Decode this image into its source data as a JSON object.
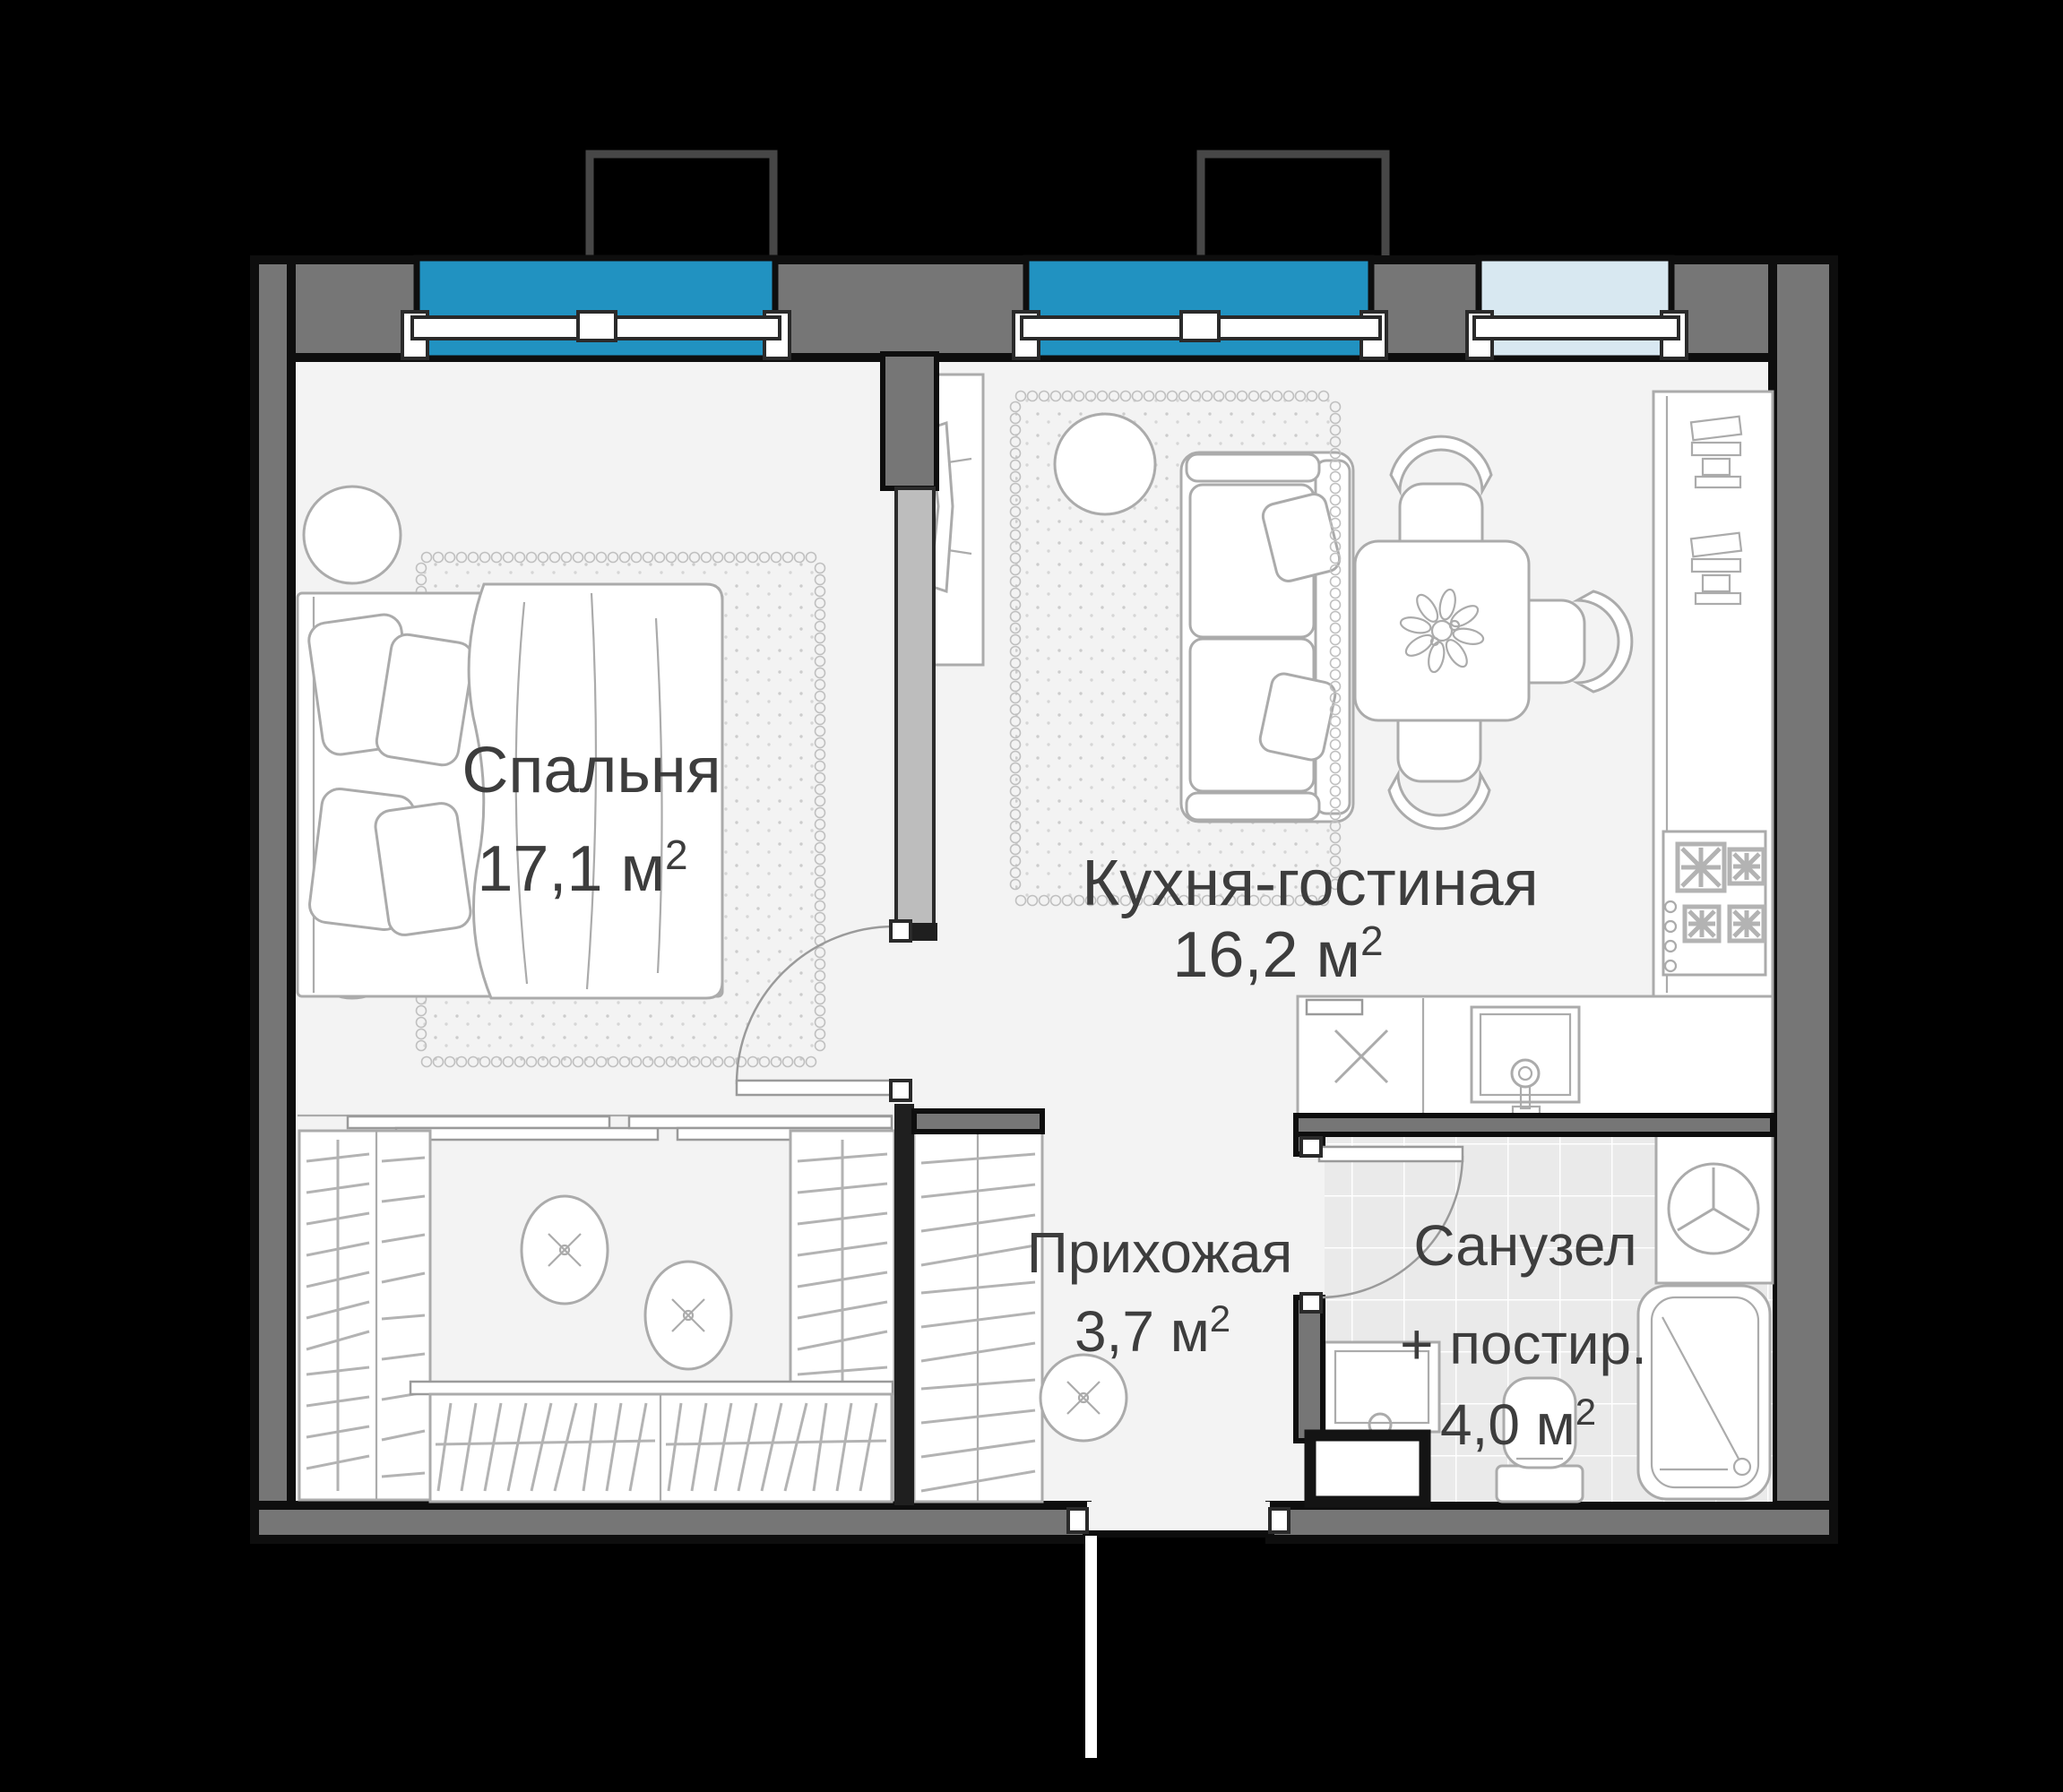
{
  "palette": {
    "background": "#000000",
    "wall": "#767676",
    "wall_outline": "#0e0e0e",
    "floor": "#f3f3f3",
    "tile": "#eaeaea",
    "furniture": "#ababab",
    "rug": "#c0c0c0",
    "text": "#3d3d3d",
    "window_active": "#2192c1",
    "window_light": "#d8e8f1",
    "balcony": "#474747"
  },
  "rooms": {
    "bedroom": {
      "name": "Спальня",
      "area_label": "17,1 м",
      "area_sup": "2"
    },
    "kitchen_living": {
      "name": "Кухня-гостиная",
      "area_label": "16,2 м",
      "area_sup": "2"
    },
    "hallway": {
      "name": "Прихожая",
      "area_label": "3,7 м",
      "area_sup": "2"
    },
    "bathroom": {
      "name_line1": "Санузел",
      "name_line2": "+ постир.",
      "area_label": "4,0 м",
      "area_sup": "2"
    }
  }
}
